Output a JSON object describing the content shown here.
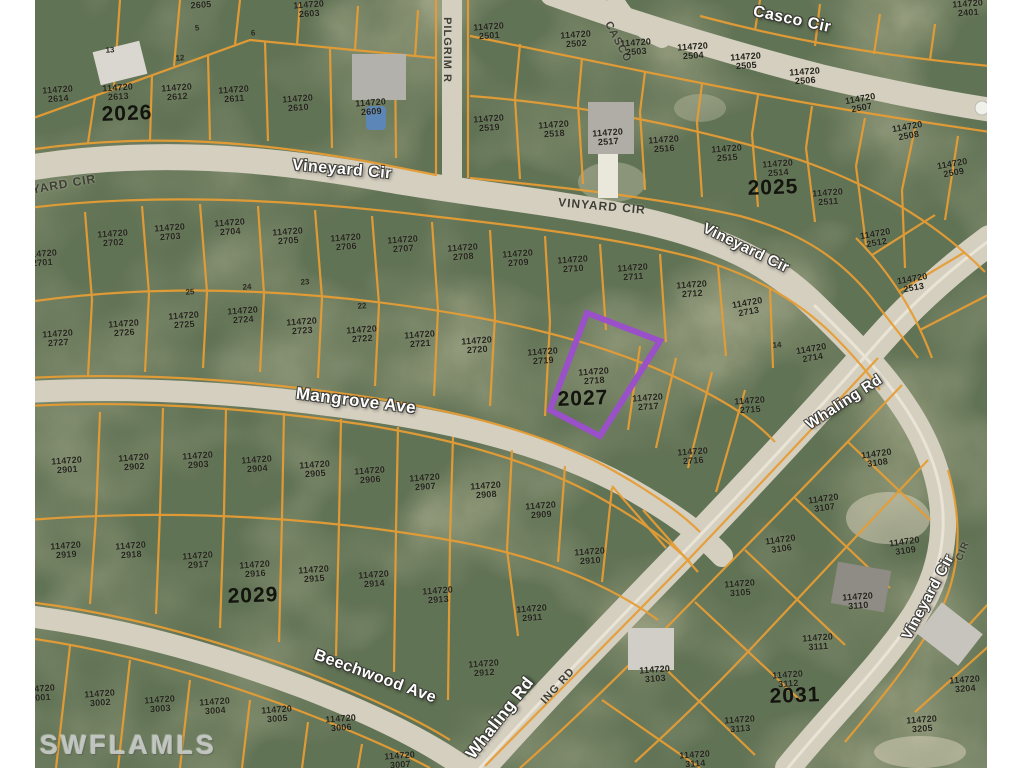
{
  "image": {
    "type": "aerial-parcel-map",
    "width": 1024,
    "height": 768
  },
  "watermark": {
    "text": "SWFLAMLS"
  },
  "colors": {
    "parcel_line": "#e69d35",
    "road_fill": "#d5cfc0",
    "highlight": "#9a50c8",
    "photo_label": "#ffffff",
    "gis_label": "#3e3e35",
    "margin": "#ffffff"
  },
  "highlighted_parcel": {
    "lot": "114720 2718",
    "block": "2027",
    "outline_color": "#9a50c8",
    "polygon": "587,313 660,341 600,436 550,410"
  },
  "lot_prefix": "114720",
  "street_labels": [
    {
      "text": "Vineyard Cir",
      "x": 342,
      "y": 170,
      "rot": 5,
      "style": "photo",
      "size": 16
    },
    {
      "text": "YARD CIR",
      "x": 64,
      "y": 184,
      "rot": -10,
      "style": "gis",
      "size": 12
    },
    {
      "text": "VINYARD CIR",
      "x": 602,
      "y": 206,
      "rot": 5,
      "style": "gis",
      "size": 12
    },
    {
      "text": "Vineyard Cir",
      "x": 746,
      "y": 248,
      "rot": 26,
      "style": "photo",
      "size": 15
    },
    {
      "text": "Casco Cir",
      "x": 792,
      "y": 20,
      "rot": 12,
      "style": "photo",
      "size": 16
    },
    {
      "text": "CASCO",
      "x": 618,
      "y": 42,
      "rot": 62,
      "style": "gis",
      "size": 11
    },
    {
      "text": "PILGRIM R",
      "x": 447,
      "y": 50,
      "rot": 90,
      "style": "gis",
      "size": 11
    },
    {
      "text": "Mangrove Ave",
      "x": 356,
      "y": 401,
      "rot": 7,
      "style": "photo",
      "size": 17
    },
    {
      "text": "Whaling Rd",
      "x": 844,
      "y": 402,
      "rot": -33,
      "style": "photo",
      "size": 15
    },
    {
      "text": "Whaling Rd",
      "x": 500,
      "y": 718,
      "rot": -52,
      "style": "photo",
      "size": 17
    },
    {
      "text": "ING RD",
      "x": 558,
      "y": 686,
      "rot": -48,
      "style": "gis",
      "size": 11
    },
    {
      "text": "Beechwood Ave",
      "x": 375,
      "y": 677,
      "rot": 20,
      "style": "photo",
      "size": 16
    },
    {
      "text": "Vineyard Cir",
      "x": 928,
      "y": 597,
      "rot": -62,
      "style": "photo",
      "size": 15
    },
    {
      "text": "CIR",
      "x": 963,
      "y": 551,
      "rot": -68,
      "style": "gis",
      "size": 10
    }
  ],
  "block_labels": [
    {
      "text": "2026",
      "x": 127,
      "y": 114
    },
    {
      "text": "2025",
      "x": 773,
      "y": 188
    },
    {
      "text": "2027",
      "x": 583,
      "y": 399
    },
    {
      "text": "2029",
      "x": 253,
      "y": 596
    },
    {
      "text": "2031",
      "x": 795,
      "y": 696
    }
  ],
  "lot_labels": [
    {
      "code": "2605",
      "x": 201,
      "y": 5,
      "code_only": true
    },
    {
      "code": "2603",
      "x": 309,
      "y": 9
    },
    {
      "code": "2614",
      "x": 58,
      "y": 94
    },
    {
      "code": "2613",
      "x": 118,
      "y": 92
    },
    {
      "code": "2612",
      "x": 177,
      "y": 92
    },
    {
      "code": "2611",
      "x": 234,
      "y": 94
    },
    {
      "code": "2610",
      "x": 298,
      "y": 103
    },
    {
      "code": "2609",
      "x": 371,
      "y": 107
    },
    {
      "code": "2501",
      "x": 489,
      "y": 31
    },
    {
      "code": "2502",
      "x": 576,
      "y": 39
    },
    {
      "code": "2503",
      "x": 636,
      "y": 47
    },
    {
      "code": "2504",
      "x": 693,
      "y": 51
    },
    {
      "code": "2505",
      "x": 746,
      "y": 61
    },
    {
      "code": "2506",
      "x": 805,
      "y": 76
    },
    {
      "code": "2507",
      "x": 861,
      "y": 103,
      "rot": -10
    },
    {
      "code": "2508",
      "x": 908,
      "y": 131,
      "rot": -10
    },
    {
      "code": "2509",
      "x": 953,
      "y": 168,
      "rot": -10
    },
    {
      "code": "2401",
      "x": 968,
      "y": 8
    },
    {
      "code": "2519",
      "x": 489,
      "y": 123
    },
    {
      "code": "2518",
      "x": 554,
      "y": 129
    },
    {
      "code": "2517",
      "x": 608,
      "y": 137
    },
    {
      "code": "2516",
      "x": 664,
      "y": 144
    },
    {
      "code": "2515",
      "x": 727,
      "y": 153
    },
    {
      "code": "2514",
      "x": 778,
      "y": 168
    },
    {
      "code": "2511",
      "x": 828,
      "y": 197
    },
    {
      "code": "2512",
      "x": 876,
      "y": 238,
      "rot": -10
    },
    {
      "code": "2513",
      "x": 913,
      "y": 283,
      "rot": -10
    },
    {
      "code": "2701",
      "x": 42,
      "y": 258
    },
    {
      "code": "2702",
      "x": 113,
      "y": 238
    },
    {
      "code": "2703",
      "x": 170,
      "y": 232
    },
    {
      "code": "2704",
      "x": 230,
      "y": 227
    },
    {
      "code": "2705",
      "x": 288,
      "y": 236
    },
    {
      "code": "2706",
      "x": 346,
      "y": 242
    },
    {
      "code": "2707",
      "x": 403,
      "y": 244
    },
    {
      "code": "2708",
      "x": 463,
      "y": 252
    },
    {
      "code": "2709",
      "x": 518,
      "y": 258
    },
    {
      "code": "2710",
      "x": 573,
      "y": 264
    },
    {
      "code": "2711",
      "x": 633,
      "y": 272
    },
    {
      "code": "2712",
      "x": 692,
      "y": 289
    },
    {
      "code": "2713",
      "x": 748,
      "y": 307,
      "rot": -10
    },
    {
      "code": "2714",
      "x": 812,
      "y": 353,
      "rot": -10
    },
    {
      "code": "2727",
      "x": 58,
      "y": 338
    },
    {
      "code": "2726",
      "x": 124,
      "y": 328
    },
    {
      "code": "2725",
      "x": 184,
      "y": 320
    },
    {
      "code": "2724",
      "x": 243,
      "y": 315
    },
    {
      "code": "2723",
      "x": 302,
      "y": 326
    },
    {
      "code": "2722",
      "x": 362,
      "y": 334
    },
    {
      "code": "2721",
      "x": 420,
      "y": 339
    },
    {
      "code": "2720",
      "x": 477,
      "y": 345
    },
    {
      "code": "2719",
      "x": 543,
      "y": 356
    },
    {
      "code": "2718",
      "x": 594,
      "y": 376
    },
    {
      "code": "2717",
      "x": 648,
      "y": 402
    },
    {
      "code": "2715",
      "x": 750,
      "y": 405
    },
    {
      "code": "2716",
      "x": 693,
      "y": 456
    },
    {
      "code": "2901",
      "x": 67,
      "y": 465
    },
    {
      "code": "2902",
      "x": 134,
      "y": 462
    },
    {
      "code": "2903",
      "x": 198,
      "y": 460
    },
    {
      "code": "2904",
      "x": 257,
      "y": 464
    },
    {
      "code": "2905",
      "x": 315,
      "y": 469
    },
    {
      "code": "2906",
      "x": 370,
      "y": 475
    },
    {
      "code": "2907",
      "x": 425,
      "y": 482
    },
    {
      "code": "2908",
      "x": 486,
      "y": 490
    },
    {
      "code": "2909",
      "x": 541,
      "y": 510
    },
    {
      "code": "2910",
      "x": 590,
      "y": 556
    },
    {
      "code": "2919",
      "x": 66,
      "y": 550
    },
    {
      "code": "2918",
      "x": 131,
      "y": 550
    },
    {
      "code": "2917",
      "x": 198,
      "y": 560
    },
    {
      "code": "2916",
      "x": 255,
      "y": 569
    },
    {
      "code": "2915",
      "x": 314,
      "y": 574
    },
    {
      "code": "2914",
      "x": 374,
      "y": 579
    },
    {
      "code": "2913",
      "x": 438,
      "y": 595
    },
    {
      "code": "2911",
      "x": 532,
      "y": 613
    },
    {
      "code": "2912",
      "x": 484,
      "y": 668
    },
    {
      "code": "3001",
      "x": 40,
      "y": 693
    },
    {
      "code": "3002",
      "x": 100,
      "y": 698
    },
    {
      "code": "3003",
      "x": 160,
      "y": 704
    },
    {
      "code": "3004",
      "x": 215,
      "y": 706
    },
    {
      "code": "3005",
      "x": 277,
      "y": 714
    },
    {
      "code": "3006",
      "x": 341,
      "y": 723
    },
    {
      "code": "3007",
      "x": 400,
      "y": 760
    },
    {
      "code": "3108",
      "x": 877,
      "y": 458,
      "rot": -8
    },
    {
      "code": "3107",
      "x": 824,
      "y": 503,
      "rot": -8
    },
    {
      "code": "3106",
      "x": 781,
      "y": 544,
      "rot": -8
    },
    {
      "code": "3109",
      "x": 905,
      "y": 546,
      "rot": -8
    },
    {
      "code": "3105",
      "x": 740,
      "y": 588
    },
    {
      "code": "3110",
      "x": 858,
      "y": 601
    },
    {
      "code": "3111",
      "x": 818,
      "y": 642
    },
    {
      "code": "3112",
      "x": 788,
      "y": 679
    },
    {
      "code": "3103",
      "x": 655,
      "y": 674
    },
    {
      "code": "3113",
      "x": 740,
      "y": 724
    },
    {
      "code": "3114",
      "x": 695,
      "y": 759
    },
    {
      "code": "3205",
      "x": 922,
      "y": 724
    },
    {
      "code": "3204",
      "x": 965,
      "y": 684
    }
  ],
  "small_numbers": [
    {
      "t": "13",
      "x": 110,
      "y": 50
    },
    {
      "t": "12",
      "x": 180,
      "y": 58
    },
    {
      "t": "5",
      "x": 197,
      "y": 28
    },
    {
      "t": "6",
      "x": 253,
      "y": 33
    },
    {
      "t": "25",
      "x": 190,
      "y": 292
    },
    {
      "t": "24",
      "x": 247,
      "y": 287
    },
    {
      "t": "23",
      "x": 305,
      "y": 282
    },
    {
      "t": "22",
      "x": 362,
      "y": 306
    },
    {
      "t": "14",
      "x": 777,
      "y": 345
    }
  ]
}
